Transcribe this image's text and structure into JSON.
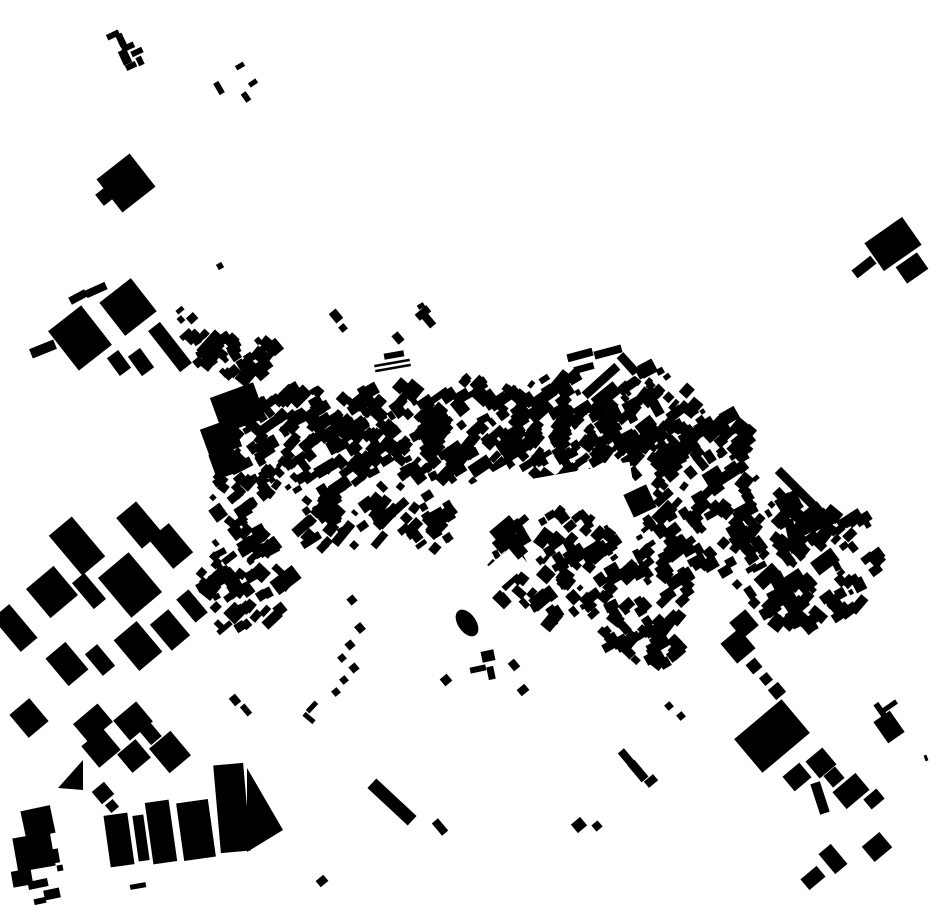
{
  "canvas": {
    "width": 930,
    "height": 924,
    "background": "#ffffff",
    "building_color": "#000000"
  },
  "buildings": [
    [
      113,
      35,
      13,
      6,
      -25
    ],
    [
      121,
      40,
      7,
      13,
      -25
    ],
    [
      128,
      47,
      13,
      6,
      -25
    ],
    [
      125,
      57,
      9,
      15,
      -25
    ],
    [
      137,
      52,
      12,
      6,
      -25
    ],
    [
      131,
      66,
      11,
      6,
      -25
    ],
    [
      140,
      61,
      6,
      9,
      -25
    ],
    [
      219,
      88,
      6,
      13,
      -30
    ],
    [
      240,
      66,
      9,
      5,
      -30
    ],
    [
      253,
      83,
      9,
      5,
      -35
    ],
    [
      246,
      97,
      6,
      10,
      -35
    ],
    [
      220,
      266,
      6,
      6,
      -30
    ],
    [
      126,
      183,
      42,
      42,
      -38
    ],
    [
      105,
      196,
      14,
      14,
      -38
    ],
    [
      893,
      244,
      46,
      34,
      -35
    ],
    [
      912,
      268,
      26,
      20,
      -35
    ],
    [
      864,
      267,
      24,
      10,
      -38
    ],
    [
      421,
      306,
      7,
      5,
      -30
    ],
    [
      43,
      349,
      26,
      10,
      -22
    ],
    [
      80,
      338,
      42,
      50,
      -38
    ],
    [
      78,
      297,
      18,
      8,
      -28
    ],
    [
      96,
      290,
      22,
      8,
      -24
    ],
    [
      128,
      307,
      40,
      42,
      -38
    ],
    [
      119,
      363,
      14,
      22,
      -36
    ],
    [
      141,
      362,
      15,
      24,
      -36
    ],
    [
      170,
      347,
      15,
      52,
      -38
    ],
    [
      275,
      347,
      12,
      14,
      -40
    ],
    [
      238,
      408,
      46,
      38,
      -20
    ],
    [
      221,
      438,
      34,
      30,
      -20
    ],
    [
      225,
      463,
      26,
      26,
      -20
    ],
    [
      394,
      355,
      20,
      6,
      -10
    ],
    [
      392,
      363,
      36,
      2.5,
      -10
    ],
    [
      393,
      368,
      36,
      2.5,
      -10
    ],
    [
      336,
      316,
      9,
      12,
      -40
    ],
    [
      343,
      328,
      7,
      7,
      -40
    ],
    [
      398,
      338,
      8,
      11,
      -40
    ],
    [
      423,
      313,
      15,
      8,
      -40
    ],
    [
      429,
      321,
      8,
      13,
      -40
    ],
    [
      511,
      541,
      13,
      38,
      -40
    ],
    [
      503,
      528,
      26,
      12,
      -40
    ],
    [
      640,
      501,
      25,
      25,
      -25
    ],
    [
      650,
      523,
      8,
      16,
      -35
    ],
    [
      802,
      494,
      9,
      68,
      -45
    ],
    [
      792,
      536,
      9,
      34,
      -12
    ],
    [
      798,
      610,
      26,
      7,
      -40
    ],
    [
      803,
      623,
      7,
      26,
      -40
    ],
    [
      660,
      642,
      17,
      15,
      -30
    ],
    [
      656,
      655,
      13,
      18,
      -30
    ],
    [
      665,
      663,
      10,
      10,
      -30
    ],
    [
      744,
      624,
      21,
      21,
      -40
    ],
    [
      738,
      646,
      24,
      26,
      -40
    ],
    [
      754,
      666,
      12,
      12,
      -40
    ],
    [
      766,
      679,
      10,
      10,
      -40
    ],
    [
      777,
      691,
      13,
      13,
      -40
    ],
    [
      772,
      736,
      62,
      44,
      -40
    ],
    [
      797,
      777,
      22,
      19,
      -40
    ],
    [
      821,
      763,
      22,
      22,
      -40
    ],
    [
      834,
      777,
      15,
      15,
      -40
    ],
    [
      851,
      791,
      30,
      22,
      -40
    ],
    [
      874,
      799,
      17,
      13,
      -40
    ],
    [
      820,
      798,
      10,
      32,
      -18
    ],
    [
      889,
      727,
      20,
      26,
      -35
    ],
    [
      881,
      711,
      6,
      18,
      -35
    ],
    [
      890,
      706,
      16,
      5,
      -35
    ],
    [
      877,
      847,
      23,
      20,
      -40
    ],
    [
      833,
      859,
      16,
      26,
      -40
    ],
    [
      813,
      878,
      21,
      14,
      -40
    ],
    [
      626,
      757,
      8,
      16,
      -40
    ],
    [
      638,
      771,
      9,
      22,
      -40
    ],
    [
      651,
      781,
      12,
      8,
      -40
    ],
    [
      669,
      706,
      7,
      7,
      -40
    ],
    [
      681,
      716,
      7,
      7,
      -40
    ],
    [
      926,
      758,
      3,
      6,
      -20
    ],
    [
      392,
      802,
      13,
      55,
      -47
    ],
    [
      440,
      827,
      8,
      16,
      -40
    ],
    [
      579,
      825,
      12,
      11,
      -40
    ],
    [
      597,
      826,
      8,
      8,
      -40
    ],
    [
      322,
      881,
      10,
      8,
      -40
    ],
    [
      312,
      707,
      13,
      5,
      -47
    ],
    [
      309,
      718,
      13,
      5,
      40
    ],
    [
      352,
      600,
      8,
      8,
      -40
    ],
    [
      360,
      628,
      8,
      9,
      -40
    ],
    [
      350,
      645,
      8,
      8,
      -40
    ],
    [
      342,
      658,
      7,
      7,
      -40
    ],
    [
      354,
      668,
      8,
      8,
      -40
    ],
    [
      344,
      680,
      7,
      7,
      -40
    ],
    [
      336,
      692,
      7,
      7,
      -40
    ],
    [
      446,
      680,
      9,
      9,
      -40
    ],
    [
      478,
      669,
      16,
      6,
      -12
    ],
    [
      491,
      673,
      7,
      13,
      -12
    ],
    [
      488,
      656,
      13,
      11,
      -12
    ],
    [
      514,
      665,
      8,
      10,
      -40
    ],
    [
      523,
      690,
      10,
      8,
      -40
    ],
    [
      235,
      700,
      8,
      10,
      -40
    ],
    [
      246,
      710,
      6,
      12,
      -40
    ],
    [
      52,
      592,
      36,
      38,
      -40
    ],
    [
      89,
      591,
      16,
      34,
      -40
    ],
    [
      130,
      585,
      40,
      52,
      -40
    ],
    [
      15,
      628,
      22,
      44,
      -40
    ],
    [
      67,
      664,
      26,
      36,
      -40
    ],
    [
      100,
      660,
      16,
      28,
      -40
    ],
    [
      138,
      646,
      30,
      40,
      -40
    ],
    [
      170,
      630,
      24,
      34,
      -40
    ],
    [
      192,
      606,
      16,
      30,
      -40
    ],
    [
      77,
      546,
      30,
      52,
      -40
    ],
    [
      139,
      525,
      26,
      40,
      -40
    ],
    [
      171,
      546,
      26,
      38,
      -40
    ],
    [
      29,
      718,
      26,
      30,
      -40
    ],
    [
      93,
      723,
      32,
      24,
      -40
    ],
    [
      101,
      748,
      28,
      28,
      -40
    ],
    [
      133,
      721,
      30,
      26,
      -40
    ],
    [
      150,
      733,
      14,
      20,
      -40
    ],
    [
      134,
      756,
      24,
      24,
      -40
    ],
    [
      170,
      752,
      28,
      32,
      -40
    ],
    [
      103,
      793,
      16,
      16,
      -40
    ],
    [
      112,
      806,
      10,
      10,
      -40
    ],
    [
      38,
      822,
      30,
      28,
      -12
    ],
    [
      34,
      852,
      38,
      34,
      -10
    ],
    [
      22,
      878,
      20,
      16,
      -10
    ],
    [
      55,
      856,
      8,
      14,
      -10
    ],
    [
      119,
      840,
      24,
      52,
      -8
    ],
    [
      141,
      838,
      11,
      46,
      -8
    ],
    [
      161,
      832,
      24,
      62,
      -8
    ],
    [
      196,
      830,
      32,
      58,
      -8
    ],
    [
      232,
      808,
      30,
      88,
      -5
    ],
    [
      38,
      884,
      20,
      8,
      -12
    ],
    [
      52,
      894,
      16,
      10,
      -12
    ],
    [
      40,
      901,
      12,
      6,
      -12
    ],
    [
      138,
      886,
      16,
      5,
      -10
    ],
    [
      60,
      868,
      6,
      6,
      -10
    ],
    [
      580,
      355,
      26,
      8,
      -15
    ],
    [
      608,
      352,
      28,
      8,
      -15
    ],
    [
      584,
      368,
      20,
      7,
      -15
    ],
    [
      601,
      381,
      44,
      9,
      -42
    ],
    [
      628,
      364,
      9,
      24,
      -42
    ]
  ],
  "ellipses": [
    [
      467,
      623,
      9,
      15,
      -35
    ]
  ],
  "triangles": [
    [
      58,
      788,
      83,
      760,
      83,
      790
    ],
    [
      247,
      768,
      283,
      830,
      247,
      852
    ]
  ],
  "white_masks": [
    [
      490,
      498,
      62,
      42,
      -30
    ],
    [
      460,
      607,
      24,
      160,
      49
    ],
    [
      572,
      481,
      120,
      18,
      -10
    ]
  ],
  "clusters": [
    {
      "cx": 237,
      "cy": 357,
      "rx": 40,
      "ry": 22,
      "count": 40,
      "rot": -40,
      "jitter": 12,
      "min": 5,
      "max": 11,
      "seed": 11
    },
    {
      "cx": 300,
      "cy": 445,
      "rx": 68,
      "ry": 60,
      "count": 115,
      "rot": -40,
      "jitter": 13,
      "min": 5,
      "max": 11,
      "seed": 12
    },
    {
      "cx": 390,
      "cy": 438,
      "rx": 60,
      "ry": 56,
      "count": 100,
      "rot": -40,
      "jitter": 13,
      "min": 5,
      "max": 11,
      "seed": 13
    },
    {
      "cx": 477,
      "cy": 430,
      "rx": 60,
      "ry": 54,
      "count": 100,
      "rot": -40,
      "jitter": 13,
      "min": 5,
      "max": 11,
      "seed": 14
    },
    {
      "cx": 563,
      "cy": 428,
      "rx": 56,
      "ry": 54,
      "count": 95,
      "rot": -40,
      "jitter": 13,
      "min": 5,
      "max": 11,
      "seed": 15
    },
    {
      "cx": 645,
      "cy": 420,
      "rx": 50,
      "ry": 56,
      "count": 85,
      "rot": -40,
      "jitter": 13,
      "min": 5,
      "max": 11,
      "seed": 16
    },
    {
      "cx": 703,
      "cy": 465,
      "rx": 56,
      "ry": 56,
      "count": 80,
      "rot": -40,
      "jitter": 13,
      "min": 5,
      "max": 11,
      "seed": 17
    },
    {
      "cx": 800,
      "cy": 560,
      "rx": 80,
      "ry": 70,
      "count": 125,
      "rot": -40,
      "jitter": 13,
      "min": 5,
      "max": 12,
      "seed": 18
    },
    {
      "cx": 560,
      "cy": 568,
      "rx": 76,
      "ry": 56,
      "count": 100,
      "rot": -40,
      "jitter": 13,
      "min": 5,
      "max": 11,
      "seed": 19
    },
    {
      "cx": 245,
      "cy": 580,
      "rx": 46,
      "ry": 58,
      "count": 65,
      "rot": -40,
      "jitter": 13,
      "min": 5,
      "max": 11,
      "seed": 20
    },
    {
      "cx": 645,
      "cy": 633,
      "rx": 42,
      "ry": 36,
      "count": 42,
      "rot": -40,
      "jitter": 13,
      "min": 5,
      "max": 11,
      "seed": 21
    },
    {
      "cx": 188,
      "cy": 327,
      "rx": 20,
      "ry": 22,
      "count": 9,
      "rot": -40,
      "jitter": 13,
      "min": 5,
      "max": 10,
      "seed": 22
    },
    {
      "cx": 230,
      "cy": 490,
      "rx": 24,
      "ry": 44,
      "count": 24,
      "rot": -40,
      "jitter": 13,
      "min": 5,
      "max": 10,
      "seed": 23
    },
    {
      "cx": 345,
      "cy": 518,
      "rx": 46,
      "ry": 34,
      "count": 42,
      "rot": -40,
      "jitter": 13,
      "min": 5,
      "max": 11,
      "seed": 24
    },
    {
      "cx": 424,
      "cy": 522,
      "rx": 34,
      "ry": 28,
      "count": 26,
      "rot": -40,
      "jitter": 13,
      "min": 5,
      "max": 11,
      "seed": 25
    },
    {
      "cx": 672,
      "cy": 558,
      "rx": 40,
      "ry": 46,
      "count": 50,
      "rot": -40,
      "jitter": 13,
      "min": 5,
      "max": 11,
      "seed": 26
    }
  ]
}
